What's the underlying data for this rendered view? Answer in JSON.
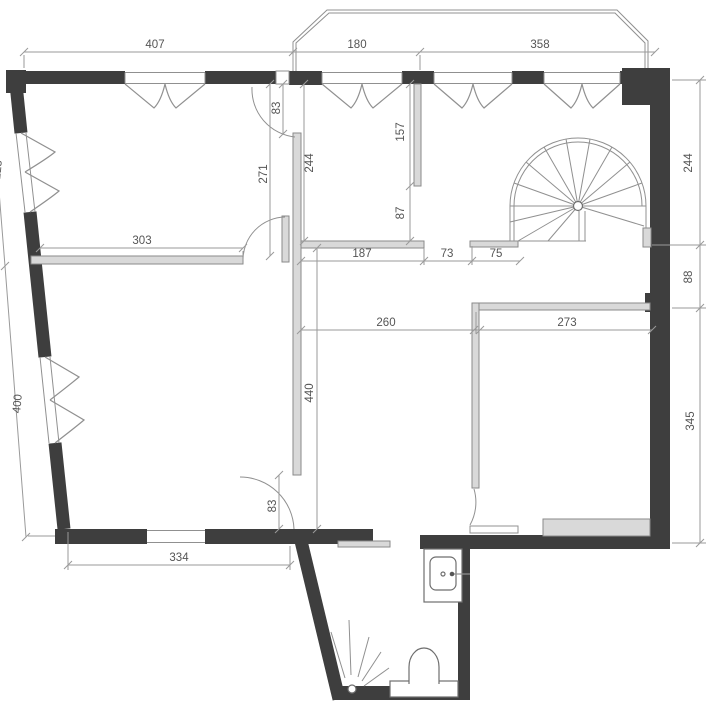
{
  "drawing": {
    "type": "architectural floor plan",
    "units_note": "",
    "colors": {
      "bg": "#ffffff",
      "wall": "#3e3e3e",
      "partition": "#d9d9d9",
      "pstroke": "#8a8a8a",
      "thin": "#909090",
      "dimline": "#9a9a9a",
      "dimtext": "#555555"
    }
  },
  "dims": [
    {
      "value": "407"
    },
    {
      "value": "180"
    },
    {
      "value": "358"
    },
    {
      "value": "223"
    },
    {
      "value": "400"
    },
    {
      "value": "83"
    },
    {
      "value": "271"
    },
    {
      "value": "244"
    },
    {
      "value": "157"
    },
    {
      "value": "87"
    },
    {
      "value": "303"
    },
    {
      "value": "187"
    },
    {
      "value": "73"
    },
    {
      "value": "75"
    },
    {
      "value": "244"
    },
    {
      "value": "88"
    },
    {
      "value": "260"
    },
    {
      "value": "273"
    },
    {
      "value": "440"
    },
    {
      "value": "345"
    },
    {
      "value": "83"
    },
    {
      "value": "334"
    }
  ]
}
